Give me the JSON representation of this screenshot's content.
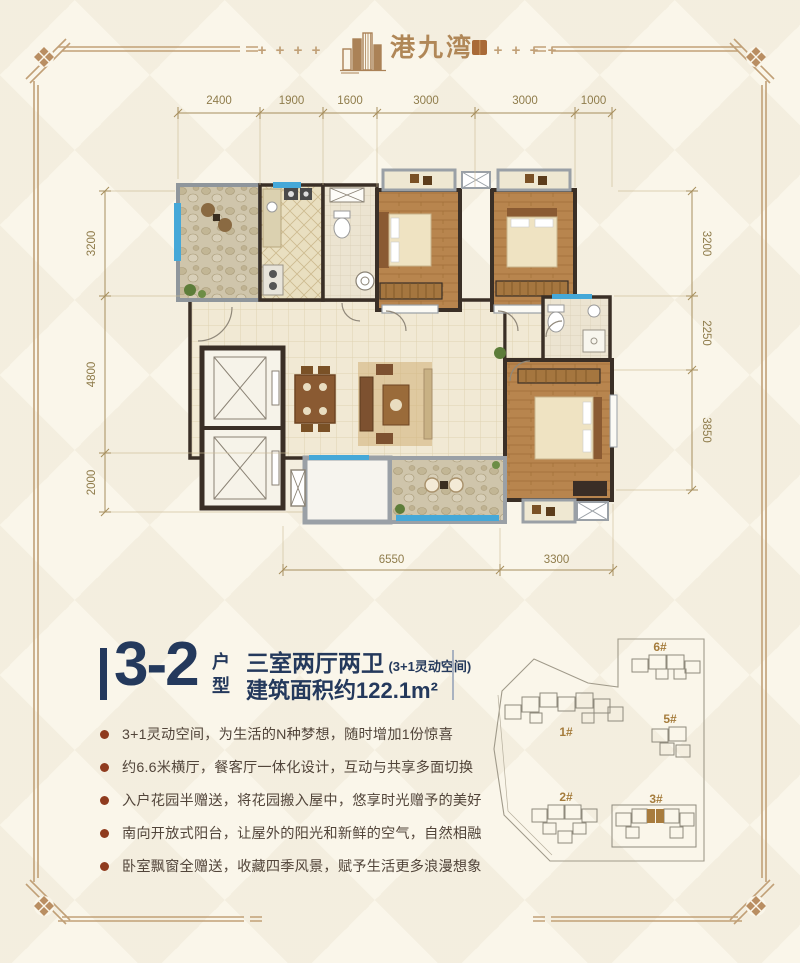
{
  "brand": {
    "name": "港九湾"
  },
  "decor": {
    "plus": "+"
  },
  "floor_plan": {
    "dims_top": [
      "2400",
      "1900",
      "1600",
      "3000",
      "3000",
      "1000"
    ],
    "dims_left": [
      "3200",
      "4800",
      "2000"
    ],
    "dims_right": [
      "3200",
      "2250",
      "3850"
    ],
    "dims_bottom": [
      "6550",
      "3300"
    ]
  },
  "unit": {
    "code": "3-2",
    "code_suffix_top": "户",
    "code_suffix_bottom": "型",
    "layout_title": "三室两厅两卫",
    "layout_note": "(3+1灵动空间)",
    "area": "建筑面积约122.1m²"
  },
  "features": [
    "3+1灵动空间，为生活的N种梦想，随时增加1份惊喜",
    "约6.6米横厅，餐客厅一体化设计，互动与共享多面切换",
    "入户花园半赠送，将花园搬入屋中，悠享时光赠予的美好",
    "南向开放式阳台，让屋外的阳光和新鲜的空气，自然相融",
    "卧室飘窗全赠送，收藏四季风景，赋予生活更多浪漫想象"
  ],
  "site_plan": {
    "buildings": [
      {
        "label": "1#",
        "highlighted": false
      },
      {
        "label": "2#",
        "highlighted": false
      },
      {
        "label": "3#",
        "highlighted": true
      },
      {
        "label": "5#",
        "highlighted": false
      },
      {
        "label": "6#",
        "highlighted": false
      }
    ]
  },
  "colors": {
    "frame": "#c1a077",
    "navy_accent": "#24395c",
    "bullet": "#8f3b1e",
    "brand_brown": "#b08757",
    "dimension": "#8f7c4b",
    "site_label_gold": "#a57c3c",
    "highlight_unit": "#a87c3e",
    "window_blue": "#45a8d8"
  }
}
